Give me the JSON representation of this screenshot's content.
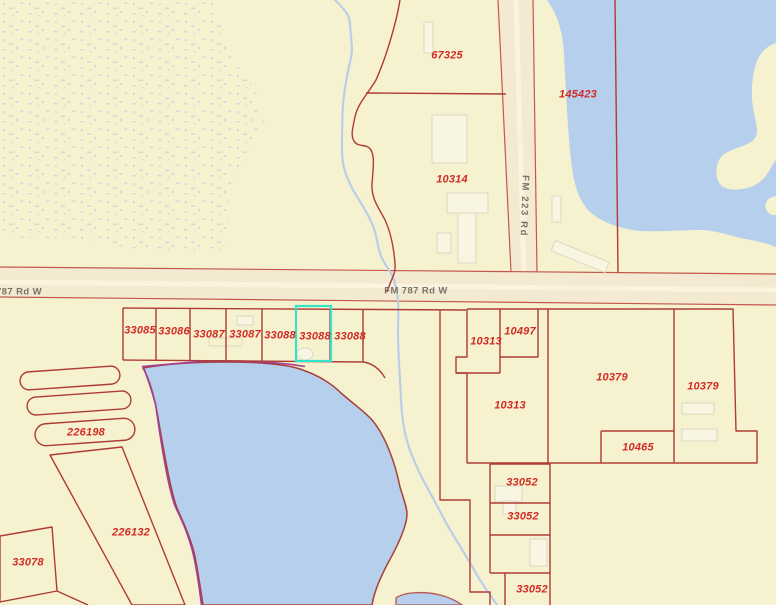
{
  "map_type": "county-appraisal-parcel-map",
  "selected_parcel": "33088",
  "colors": {
    "background": "#f6f2cf",
    "water": "#b5cfec",
    "road_fill": "#f4ead1",
    "road_stripe": "#faf3de",
    "road_edge": "#c4574e",
    "parcel_line": "#ad3c35",
    "parcel_label": "#d22b27",
    "road_label": "#76736a",
    "highlight": "#35e3c9",
    "survey_line": "#a23f97",
    "creek": "#b9cfe6",
    "marsh_dots": "#c8d1e3",
    "building_fill": "#f8f5e3",
    "building_edge": "#ded8c2"
  },
  "roads": {
    "fm787": {
      "label_center": "FM 787 Rd W",
      "label_left": "787 Rd W"
    },
    "fm223": {
      "label": "FM 223 Rd"
    }
  },
  "parcels": [
    {
      "id": "67325"
    },
    {
      "id": "145423"
    },
    {
      "id": "10314"
    },
    {
      "id": "33085"
    },
    {
      "id": "33086"
    },
    {
      "id": "33087"
    },
    {
      "id": "33087"
    },
    {
      "id": "33088"
    },
    {
      "id": "33088",
      "highlighted": true
    },
    {
      "id": "33088"
    },
    {
      "id": "10313"
    },
    {
      "id": "10497"
    },
    {
      "id": "10313"
    },
    {
      "id": "10379"
    },
    {
      "id": "10379"
    },
    {
      "id": "10465"
    },
    {
      "id": "33052"
    },
    {
      "id": "33052"
    },
    {
      "id": "33052"
    },
    {
      "id": "226198"
    },
    {
      "id": "226132"
    },
    {
      "id": "33078"
    }
  ]
}
